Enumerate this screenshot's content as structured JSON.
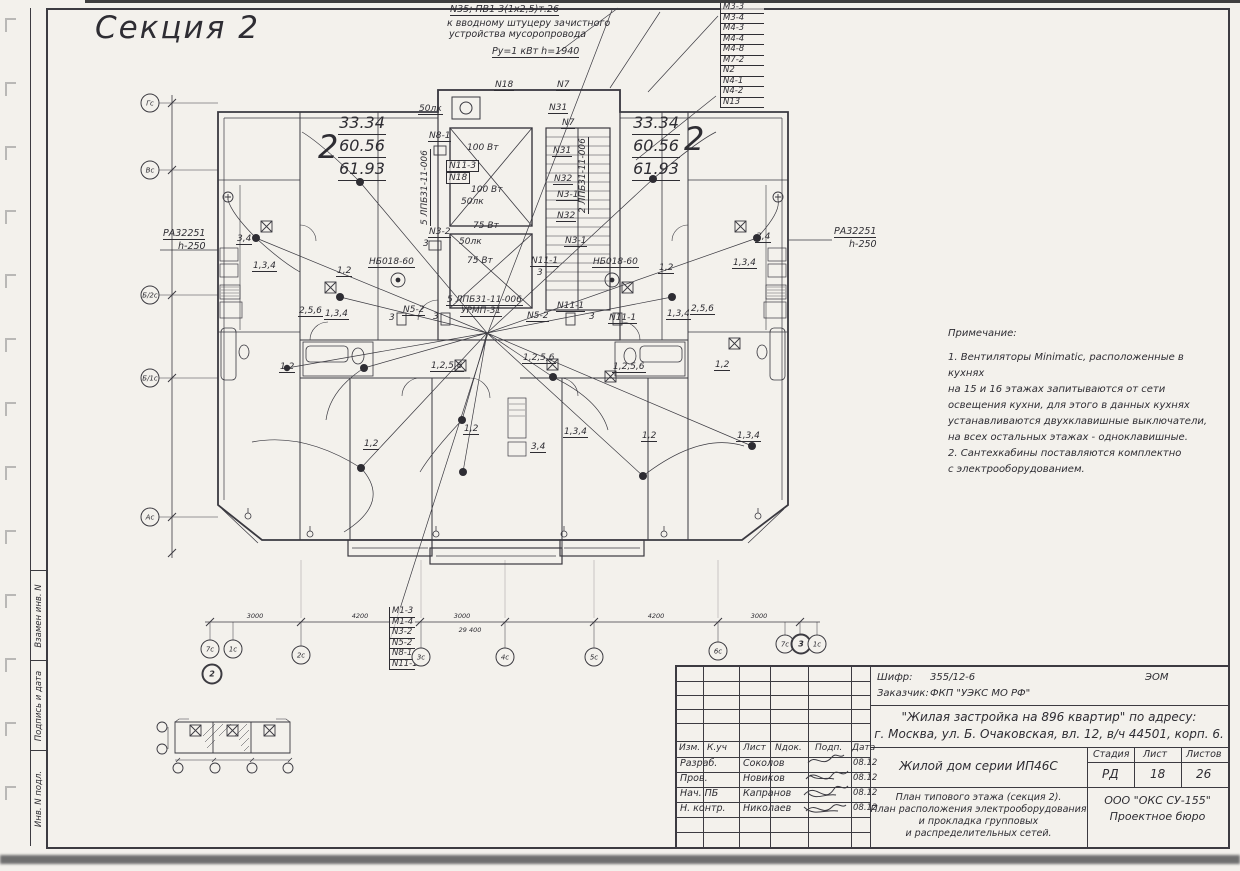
{
  "title": "Секция 2",
  "colors": {
    "paper": "#f3f1ec",
    "ink": "#2e2d33",
    "scan_shadow": "#6f6f6f"
  },
  "top_annotation": {
    "l1": "N35; ПВ1 3(1х2,5)т.26",
    "l2": "к вводному штуцеру зачистного",
    "l3": "устройства мусоропровода",
    "l4": "Ру=1 кВт  h=1940"
  },
  "top_right_list": [
    "М3-3",
    "М3-4",
    "М4-3",
    "М4-4",
    "М4-8",
    "М7-2",
    "N2",
    "N4-1",
    "N4-2",
    "N13"
  ],
  "bottom_list": [
    "М1-3",
    "М1-4",
    "N3-2",
    "N5-2",
    "N8-1",
    "N11-1"
  ],
  "pa_panel": {
    "line1": "РА32251",
    "line2": "h-250"
  },
  "apartments": {
    "number": "2",
    "area1": "33.34",
    "area2": "60.56",
    "area3": "61.93"
  },
  "left_axis": [
    {
      "t": "Гс",
      "x": 150,
      "y": 103
    },
    {
      "t": "Вс",
      "x": 150,
      "y": 170
    },
    {
      "t": "Б/2с",
      "x": 150,
      "y": 295
    },
    {
      "t": "Б/1с",
      "x": 150,
      "y": 378
    },
    {
      "t": "Ас",
      "x": 150,
      "y": 517
    }
  ],
  "bottom_axis": [
    {
      "t": "7с",
      "x": 210,
      "y": 649
    },
    {
      "t": "1с",
      "x": 233,
      "y": 649
    },
    {
      "t": "2",
      "x": 212,
      "y": 674,
      "cls": "bold"
    },
    {
      "t": "2с",
      "x": 301,
      "y": 655
    },
    {
      "t": "3с",
      "x": 421,
      "y": 657
    },
    {
      "t": "4с",
      "x": 505,
      "y": 657
    },
    {
      "t": "5с",
      "x": 594,
      "y": 657
    },
    {
      "t": "6с",
      "x": 718,
      "y": 651
    },
    {
      "t": "7с",
      "x": 785,
      "y": 644
    },
    {
      "t": "3",
      "x": 801,
      "y": 644,
      "cls": "bold"
    },
    {
      "t": "1с",
      "x": 817,
      "y": 644
    }
  ],
  "bottom_dims": [
    {
      "t": "3000",
      "x": 255,
      "y": 612
    },
    {
      "t": "4200",
      "x": 360,
      "y": 612
    },
    {
      "t": "3000",
      "x": 462,
      "y": 612
    },
    {
      "t": "29 400",
      "x": 470,
      "y": 626
    },
    {
      "t": "4200",
      "x": 656,
      "y": 612
    },
    {
      "t": "3000",
      "x": 759,
      "y": 612
    }
  ],
  "plan_labels": [
    {
      "t": "N18",
      "x": 494,
      "y": 80
    },
    {
      "t": "N7",
      "x": 556,
      "y": 80
    },
    {
      "t": "50лк",
      "x": 418,
      "y": 104
    },
    {
      "t": "N8-1",
      "x": 428,
      "y": 131
    },
    {
      "t": "100 Вт",
      "x": 466,
      "y": 143,
      "cls": "plain"
    },
    {
      "t": "N11-3",
      "x": 446,
      "y": 160,
      "cls": "box"
    },
    {
      "t": "N18",
      "x": 446,
      "y": 172,
      "cls": "box"
    },
    {
      "t": "100 Вт",
      "x": 470,
      "y": 185,
      "cls": "plain"
    },
    {
      "t": "50лк",
      "x": 460,
      "y": 197,
      "cls": "plain"
    },
    {
      "t": "5 ЛПБ31-11-006",
      "x": 420,
      "y": 226,
      "r": -90
    },
    {
      "t": "N3-2",
      "x": 428,
      "y": 227
    },
    {
      "t": "3",
      "x": 422,
      "y": 239,
      "cls": "plain"
    },
    {
      "t": "75 Вт",
      "x": 472,
      "y": 221,
      "cls": "plain"
    },
    {
      "t": "50лк",
      "x": 458,
      "y": 237,
      "cls": "plain"
    },
    {
      "t": "75 Вт",
      "x": 466,
      "y": 256,
      "cls": "plain"
    },
    {
      "t": "N31",
      "x": 548,
      "y": 103
    },
    {
      "t": "N7",
      "x": 561,
      "y": 118
    },
    {
      "t": "N31",
      "x": 552,
      "y": 146
    },
    {
      "t": "N32",
      "x": 553,
      "y": 174
    },
    {
      "t": "N3-1",
      "x": 556,
      "y": 190
    },
    {
      "t": "2 ЛПБ31-11-006",
      "x": 578,
      "y": 214,
      "r": -90
    },
    {
      "t": "N32",
      "x": 556,
      "y": 211
    },
    {
      "t": "N3-1",
      "x": 564,
      "y": 236
    },
    {
      "t": "N11-1",
      "x": 530,
      "y": 256
    },
    {
      "t": "3",
      "x": 536,
      "y": 268,
      "cls": "plain"
    },
    {
      "t": "5 ЛПБ31-11-006",
      "x": 446,
      "y": 295
    },
    {
      "t": "УРМП-31",
      "x": 460,
      "y": 306
    },
    {
      "t": "N5-2",
      "x": 526,
      "y": 311
    },
    {
      "t": "N11-1",
      "x": 556,
      "y": 301
    },
    {
      "t": "N11-1",
      "x": 608,
      "y": 313
    },
    {
      "t": "N5-2",
      "x": 402,
      "y": 305
    },
    {
      "t": "3",
      "x": 388,
      "y": 313,
      "cls": "plain"
    },
    {
      "t": "3",
      "x": 432,
      "y": 312,
      "cls": "plain"
    },
    {
      "t": "3",
      "x": 588,
      "y": 312,
      "cls": "plain"
    },
    {
      "t": "3,4",
      "x": 236,
      "y": 234
    },
    {
      "t": "1,3,4",
      "x": 252,
      "y": 261
    },
    {
      "t": "НБ018-60",
      "x": 368,
      "y": 257
    },
    {
      "t": "1,2",
      "x": 336,
      "y": 266
    },
    {
      "t": "2,5,6",
      "x": 298,
      "y": 306
    },
    {
      "t": "1,3,4",
      "x": 324,
      "y": 309
    },
    {
      "t": "1,2",
      "x": 279,
      "y": 362
    },
    {
      "t": "3,4",
      "x": 755,
      "y": 232
    },
    {
      "t": "1,3,4",
      "x": 732,
      "y": 258
    },
    {
      "t": "НБ018-60",
      "x": 592,
      "y": 257
    },
    {
      "t": "1,2",
      "x": 658,
      "y": 263
    },
    {
      "t": "2,5,6",
      "x": 690,
      "y": 304
    },
    {
      "t": "1,3,4",
      "x": 666,
      "y": 309
    },
    {
      "t": "1,2",
      "x": 714,
      "y": 360
    },
    {
      "t": "1,2,5,6",
      "x": 430,
      "y": 361
    },
    {
      "t": "1,2,5,6",
      "x": 522,
      "y": 353
    },
    {
      "t": "1,2,5,6",
      "x": 612,
      "y": 362
    },
    {
      "t": "1,2",
      "x": 363,
      "y": 439
    },
    {
      "t": "1,2",
      "x": 463,
      "y": 424
    },
    {
      "t": "3,4",
      "x": 530,
      "y": 442
    },
    {
      "t": "1,3,4",
      "x": 563,
      "y": 427
    },
    {
      "t": "1,2",
      "x": 641,
      "y": 431
    },
    {
      "t": "1,3,4",
      "x": 736,
      "y": 431
    }
  ],
  "notes": {
    "title": "Примечание:",
    "lines": [
      "1. Вентиляторы Minimatic, расположенные в кухнях",
      "на 15 и 16 этажах запитываются от сети",
      "освещения кухни, для этого в данных кухнях",
      "устанавливаются двухклавишные выключатели,",
      "на всех остальных этажах - одноклавишные.",
      "2. Сантехкабины поставляются комплектно",
      "с электрооборудованием."
    ]
  },
  "side_stamps": [
    "Взамен инв. N",
    "Подпись и дата",
    "Инв. N подл."
  ],
  "stamp": {
    "shifr_label": "Шифр:",
    "shifr": "355/12-6",
    "code": "ЭОМ",
    "customer_label": "Заказчик:",
    "customer": "ФКП \"УЭКС МО РФ\"",
    "project_line1": "\"Жилая застройка на 896 квартир\" по адресу:",
    "project_line2": "г. Москва, ул. Б. Очаковская, вл. 12, в/ч 44501, корп. 6.",
    "header_cols": [
      {
        "t": "Изм.",
        "x": 2
      },
      {
        "t": "К.уч",
        "x": 30
      },
      {
        "t": "Лист",
        "x": 66
      },
      {
        "t": "Nдок.",
        "x": 98
      },
      {
        "t": "Подп.",
        "x": 138
      },
      {
        "t": "Дата",
        "x": 175
      }
    ],
    "sig_rows": [
      {
        "role": "Разраб.",
        "name": "Соколов",
        "date": "08.12"
      },
      {
        "role": "Пров.",
        "name": "Новиков",
        "date": "08.12"
      },
      {
        "role": "Нач. ПБ",
        "name": "Капранов",
        "date": "08.12"
      },
      {
        "role": "Н. контр.",
        "name": "Николаев",
        "date": "08.12"
      }
    ],
    "object_name": "Жилой дом серии ИП46С",
    "stage_label": "Стадия",
    "sheet_label": "Лист",
    "sheets_label": "Листов",
    "stage": "РД",
    "sheet": "18",
    "sheets": "26",
    "desc_lines": [
      "План типового этажа (секция 2).",
      "План расположения электрооборудования",
      "и прокладка групповых",
      "и распределительных сетей."
    ],
    "org_lines": [
      "ООО \"ОКС СУ-155\"",
      "Проектное бюро"
    ]
  }
}
